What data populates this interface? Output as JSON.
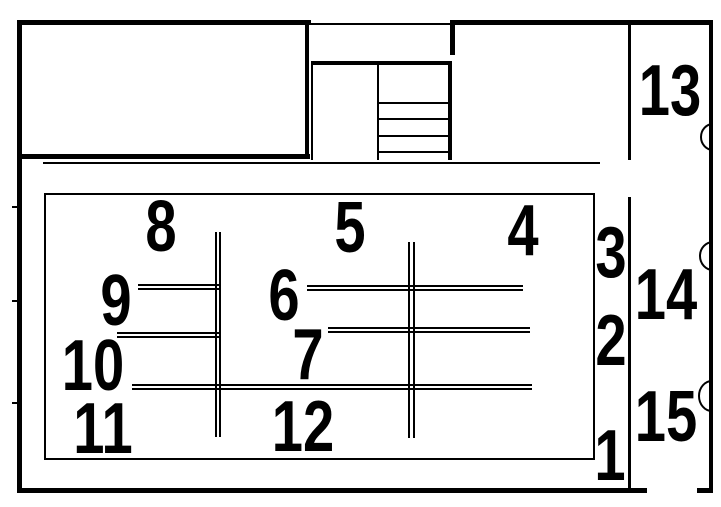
{
  "diagram": {
    "type": "floor-plan",
    "background": "#ffffff",
    "line_color": "#000000",
    "text_color": "#000000"
  },
  "labels": [
    {
      "id": "bay-1",
      "text": "1"
    },
    {
      "id": "bay-2",
      "text": "2"
    },
    {
      "id": "bay-3",
      "text": "3"
    },
    {
      "id": "bay-4",
      "text": "4"
    },
    {
      "id": "bay-5",
      "text": "5"
    },
    {
      "id": "bay-6",
      "text": "6"
    },
    {
      "id": "bay-7",
      "text": "7"
    },
    {
      "id": "bay-8",
      "text": "8"
    },
    {
      "id": "bay-9",
      "text": "9"
    },
    {
      "id": "bay-10",
      "text": "10"
    },
    {
      "id": "bay-11",
      "text": "11"
    },
    {
      "id": "bay-12",
      "text": "12"
    },
    {
      "id": "bay-13",
      "text": "13"
    },
    {
      "id": "bay-14",
      "text": "14"
    },
    {
      "id": "bay-15",
      "text": "15"
    }
  ]
}
